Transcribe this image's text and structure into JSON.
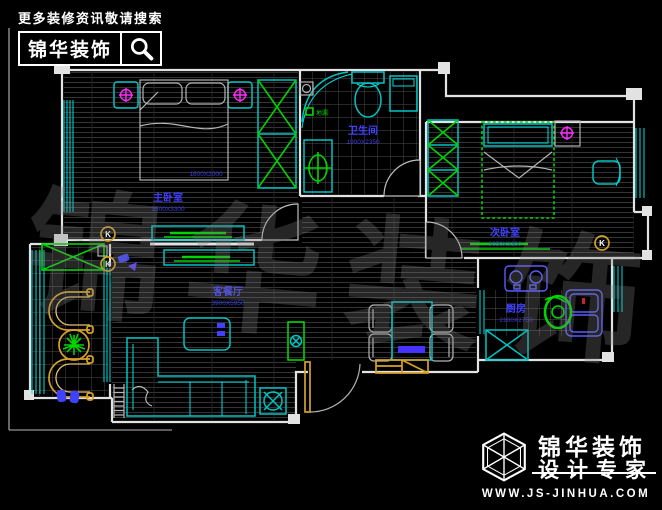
{
  "header": {
    "tagline": "更多装修资讯敬请搜索",
    "brand": "锦华装饰",
    "search_icon": "magnifier-icon"
  },
  "watermark": {
    "text": "锦华装饰"
  },
  "plan": {
    "type": "apartment-floor-plan",
    "rooms": [
      {
        "name": "master-bedroom",
        "label": "主卧室",
        "dim": "3500X3300"
      },
      {
        "name": "bathroom",
        "label": "卫生间",
        "dim": "1900X2350"
      },
      {
        "name": "second-bedroom",
        "label": "次卧室",
        "dim": "3050X3300"
      },
      {
        "name": "kitchen",
        "label": "厨房",
        "dim": "2100X2750"
      },
      {
        "name": "living-dining",
        "label": "客餐厅",
        "dim": "3900X5950"
      }
    ],
    "annotations": {
      "bed_dim": "1800X2000",
      "floor_drain": "地漏",
      "switch_label": "K"
    },
    "colors": {
      "wall": "#e2e2e2",
      "furniture_cyan": "#00c4c4",
      "accent_green": "#00d400",
      "lamp_magenta": "#ff2bff",
      "label_blue": "#4040ff",
      "wood_yellow": "#d7a128",
      "background": "#000000"
    }
  },
  "footer": {
    "brand": "锦华装饰",
    "subtitle": "设计专家",
    "website": "WWW.JS-JINHUA.COM",
    "logo": "wireframe-cube-icon"
  }
}
